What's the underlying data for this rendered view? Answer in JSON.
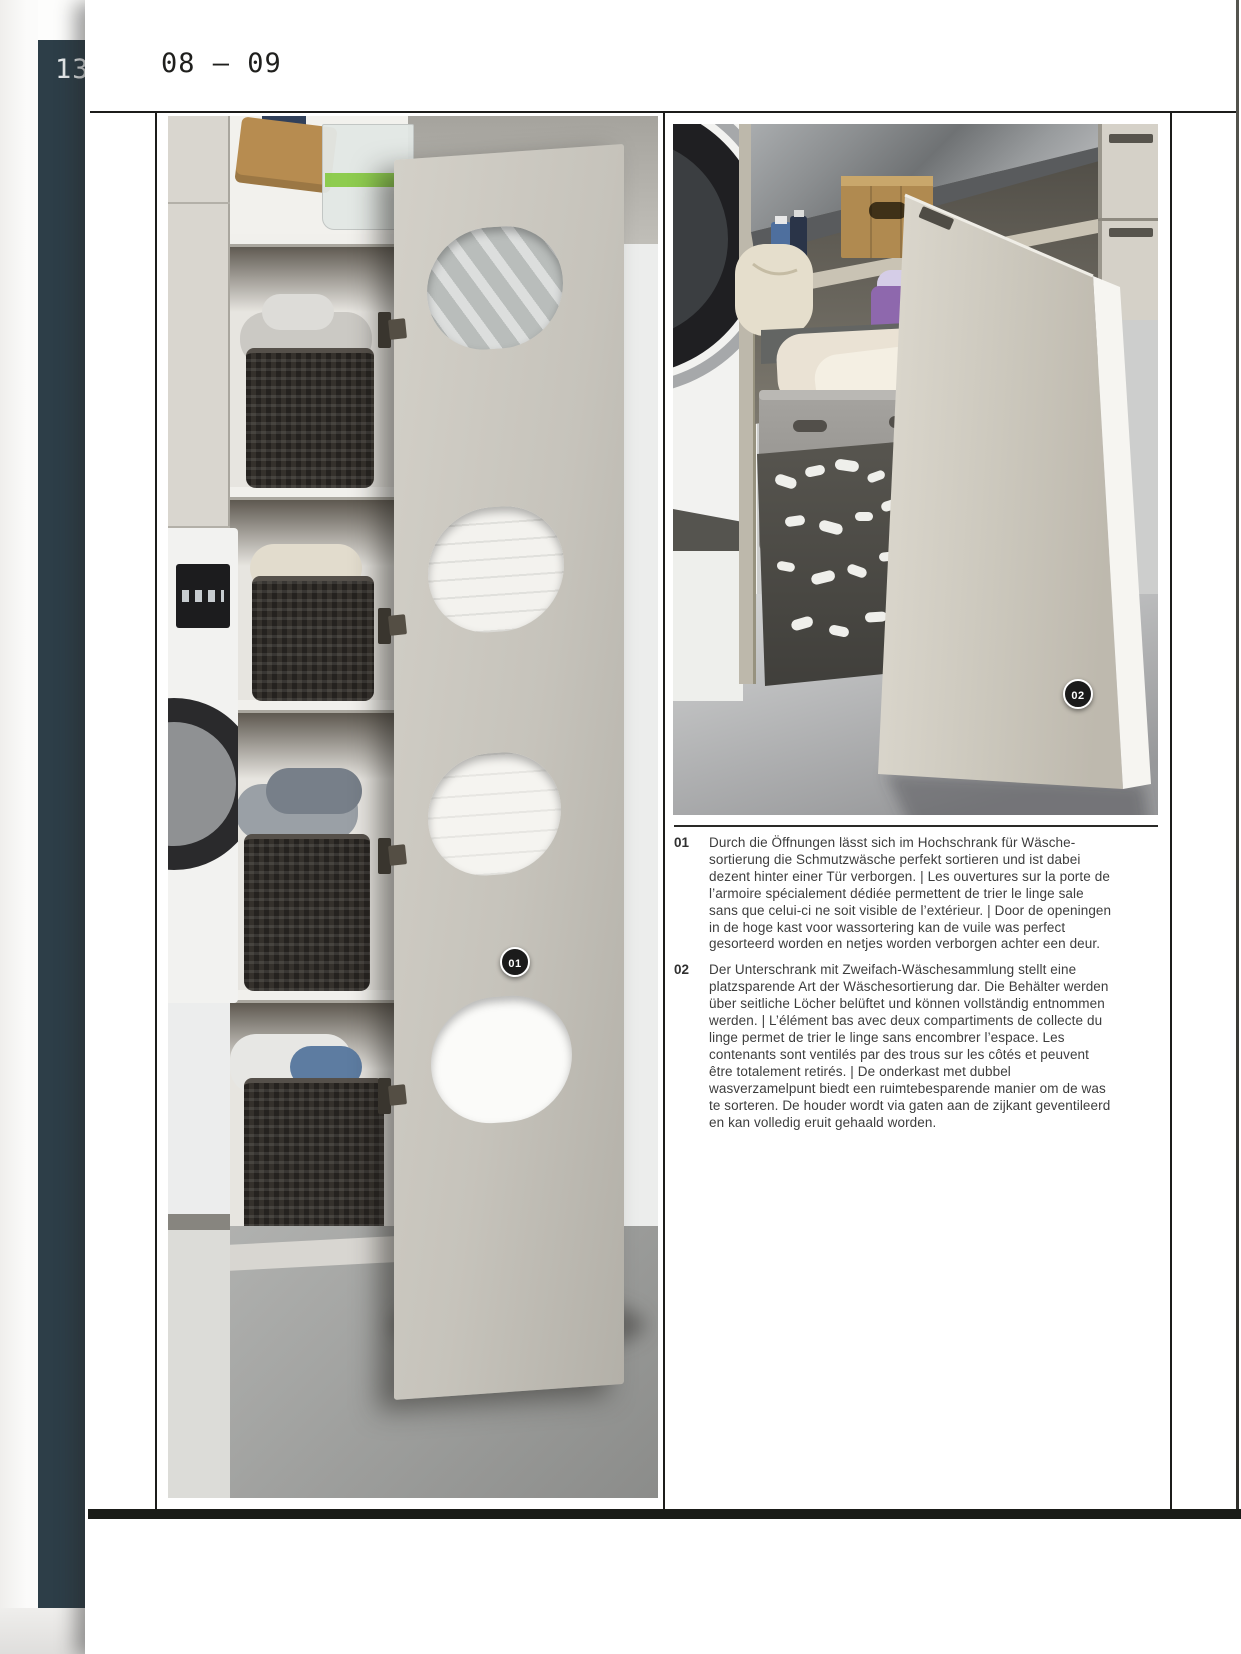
{
  "page": {
    "spread_label": "08 — 09",
    "adjacent_page_number": "13"
  },
  "figures": {
    "left_badge": "01",
    "right_badge": "02"
  },
  "captions": [
    {
      "num": "01",
      "text": "Durch die Öffnungen lässt sich im Hochschrank für Wäsche-sortierung die Schmutzwäsche perfekt sortieren und ist dabei dezent hinter einer Tür verborgen. | Les ouvertures sur la porte de l’armoire spécialement dédiée permettent de trier le linge sale sans que celui-ci ne soit visible de l’extérieur. | Door de openingen in de hoge kast voor wassortering kan de vuile was perfect gesorteerd worden en netjes worden verborgen achter een deur."
    },
    {
      "num": "02",
      "text": "Der Unterschrank mit Zweifach-Wäschesammlung stellt eine platzsparende Art der Wäschesortierung dar. Die Behälter werden über seitliche Löcher belüftet und können vollständig entnommen werden. | L’élément bas avec deux compartiments de collecte du linge permet de trier le linge sans encombrer l’espace. Les contenants sont ventilés par des trous sur les côtés et peuvent être totalement retirés. | De onderkast met dubbel wasverzamelpunt biedt een ruimtebesparende manier om de was te sorteren. De houder wordt via gaten aan de zijkant geventileerd en kan volledig eruit gehaald worden."
    }
  ],
  "colors": {
    "sidebar_band": "#2d3e48",
    "footer_bar": "#1a1c18",
    "badge": "#1b1b1b",
    "frame_lines": "#1c1c1a"
  }
}
